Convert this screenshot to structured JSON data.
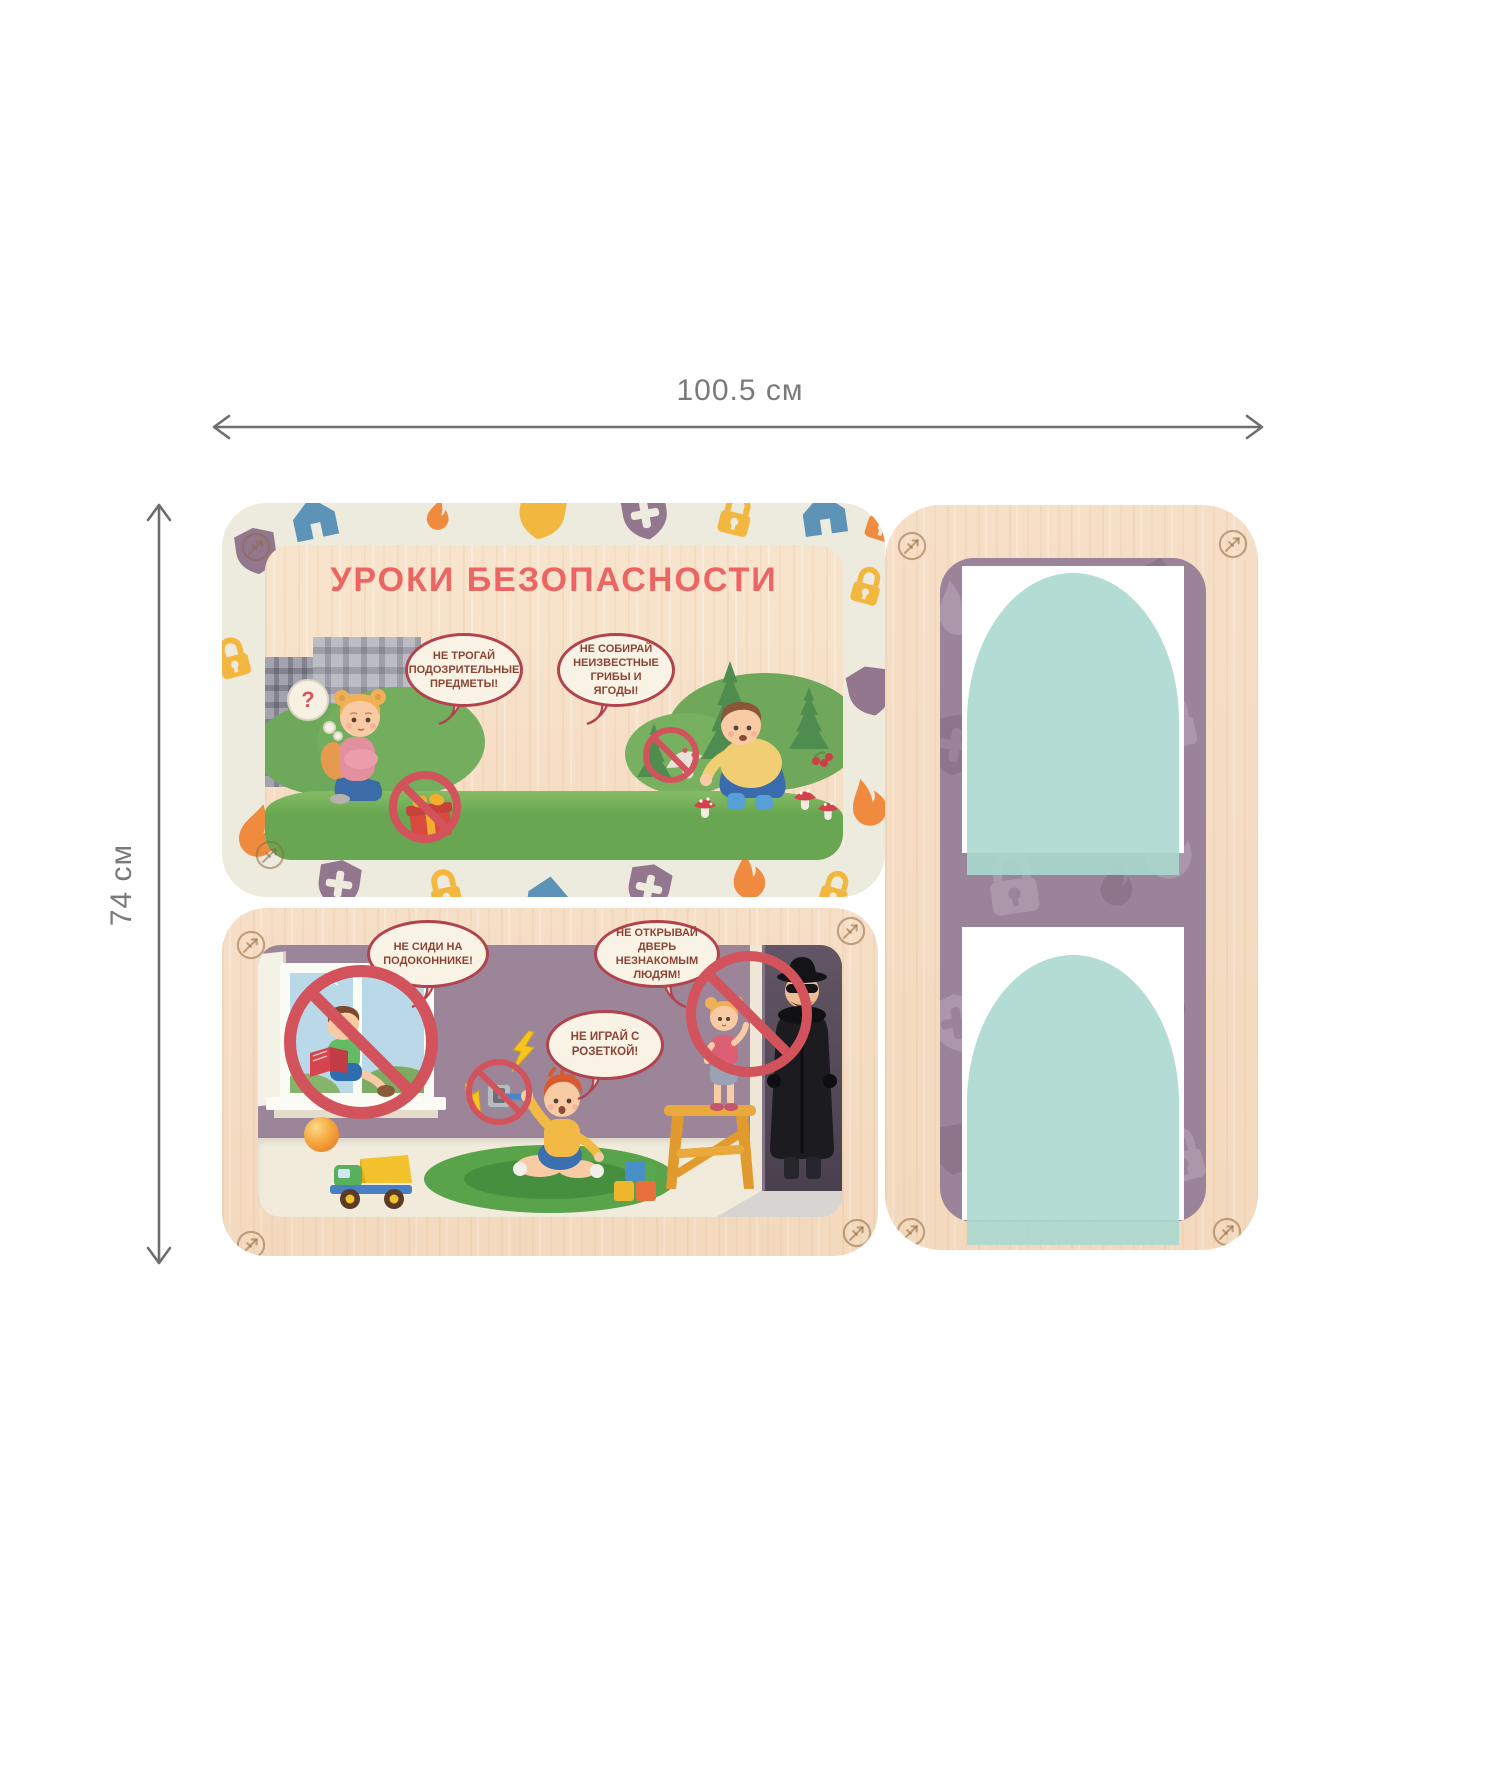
{
  "dimensions": {
    "width_label": "100.5 см",
    "height_label": "74 см"
  },
  "top_board": {
    "title": "УРОКИ БЕЗОПАСНОСТИ",
    "thought_mark": "?",
    "speech_bubbles": [
      {
        "text": "НЕ ТРОГАЙ ПОДОЗРИТЕЛЬНЫЕ ПРЕДМЕТЫ!"
      },
      {
        "text": "НЕ СОБИРАЙ НЕИЗВЕСТНЫЕ ГРИБЫ И ЯГОДЫ!"
      }
    ]
  },
  "bottom_board": {
    "speech_bubbles": [
      {
        "text": "НЕ СИДИ НА ПОДОКОННИКЕ!"
      },
      {
        "text": "НЕ ОТКРЫВАЙ ДВЕРЬ НЕЗНАКОМЫМ ЛЮДЯМ!"
      },
      {
        "text": "НЕ ИГРАЙ С РОЗЕТКОЙ!"
      }
    ]
  },
  "right_board": {
    "photo_slots": 2
  },
  "palette": {
    "wood": "#f5dcc3",
    "cream": "#edeade",
    "purple_panel": "#9b8399",
    "teal_arch": "#aad8cf",
    "ban_red": "#d2535b",
    "bubble_border": "#b2434e",
    "bubble_text": "#8c4435",
    "title": "#ec6562",
    "dim_gray": "#7a7a7a",
    "icon_blue": "#5e93b8",
    "icon_orange": "#ef8a3e",
    "icon_yellow": "#f2b73f",
    "icon_purple": "#93778f"
  },
  "scatter": [
    {
      "host": "top-border",
      "items": [
        {
          "t": "house",
          "c": "#5e93b8",
          "x": 62,
          "y": -16,
          "s": 60,
          "r": -12
        },
        {
          "t": "flame",
          "c": "#ef8a3e",
          "x": 196,
          "y": -6,
          "s": 40,
          "r": 8
        },
        {
          "t": "shield",
          "c": "#f2b73f",
          "x": 288,
          "y": -22,
          "s": 64,
          "r": 10
        },
        {
          "t": "shieldx",
          "c": "#93778f",
          "x": 392,
          "y": -20,
          "s": 62,
          "r": -10
        },
        {
          "t": "lock",
          "c": "#f2b73f",
          "x": 486,
          "y": -16,
          "s": 56,
          "r": 14
        },
        {
          "t": "house",
          "c": "#5e93b8",
          "x": 572,
          "y": -20,
          "s": 60,
          "r": -8
        },
        {
          "t": "lock",
          "c": "#ef8a3e",
          "x": 634,
          "y": -10,
          "s": 56,
          "r": 18
        },
        {
          "t": "shield",
          "c": "#93778f",
          "x": 6,
          "y": 20,
          "s": 56,
          "r": -8
        },
        {
          "t": "lock",
          "c": "#f2b73f",
          "x": -16,
          "y": 128,
          "s": 54,
          "r": -15
        },
        {
          "t": "flame",
          "c": "#ef8a3e",
          "x": 2,
          "y": 298,
          "s": 68,
          "r": 10
        },
        {
          "t": "lock",
          "c": "#f2b73f",
          "x": 620,
          "y": 58,
          "s": 50,
          "r": 15
        },
        {
          "t": "shield",
          "c": "#93778f",
          "x": 618,
          "y": 158,
          "s": 60,
          "r": -12
        },
        {
          "t": "flame",
          "c": "#ef8a3e",
          "x": 616,
          "y": 272,
          "s": 62,
          "r": -18
        },
        {
          "t": "shieldx",
          "c": "#93778f",
          "x": 88,
          "y": 352,
          "s": 58,
          "r": 8
        },
        {
          "t": "lock",
          "c": "#f2b73f",
          "x": 196,
          "y": 360,
          "s": 54,
          "r": -12
        },
        {
          "t": "house",
          "c": "#5e93b8",
          "x": 298,
          "y": 364,
          "s": 56,
          "r": 8
        },
        {
          "t": "shieldx",
          "c": "#93778f",
          "x": 398,
          "y": 356,
          "s": 58,
          "r": 12
        },
        {
          "t": "flame",
          "c": "#ef8a3e",
          "x": 498,
          "y": 348,
          "s": 58,
          "r": -10
        },
        {
          "t": "lock",
          "c": "#f2b73f",
          "x": 588,
          "y": 362,
          "s": 50,
          "r": 16
        }
      ]
    },
    {
      "host": "purple-pattern",
      "items": [
        {
          "t": "flame",
          "c": "#ac96a9",
          "x": -18,
          "y": 18,
          "s": 72,
          "r": -15
        },
        {
          "t": "house",
          "c": "#8d7689",
          "x": 176,
          "y": -14,
          "s": 78,
          "r": 12
        },
        {
          "t": "lock",
          "c": "#ac96a9",
          "x": 198,
          "y": 128,
          "s": 72,
          "r": -12
        },
        {
          "t": "shieldx",
          "c": "#8d7689",
          "x": -22,
          "y": 150,
          "s": 74,
          "r": 8
        },
        {
          "t": "flame",
          "c": "#ac96a9",
          "x": 188,
          "y": 252,
          "s": 84,
          "r": 20
        },
        {
          "t": "lock",
          "c": "#ac96a9",
          "x": 30,
          "y": 282,
          "s": 86,
          "r": -8
        },
        {
          "t": "flame",
          "c": "#8d7689",
          "x": 148,
          "y": 300,
          "s": 58,
          "r": 12
        },
        {
          "t": "shieldx",
          "c": "#ac96a9",
          "x": -18,
          "y": 430,
          "s": 70,
          "r": -8
        },
        {
          "t": "lock",
          "c": "#8d7689",
          "x": 196,
          "y": 430,
          "s": 64,
          "r": 18
        },
        {
          "t": "lock",
          "c": "#ac96a9",
          "x": 204,
          "y": 560,
          "s": 74,
          "r": -15
        },
        {
          "t": "shield",
          "c": "#8d7689",
          "x": -14,
          "y": 560,
          "s": 62,
          "r": 10
        },
        {
          "t": "lock",
          "c": "#ac96a9",
          "x": 140,
          "y": 620,
          "s": 66,
          "r": -8
        }
      ]
    }
  ]
}
